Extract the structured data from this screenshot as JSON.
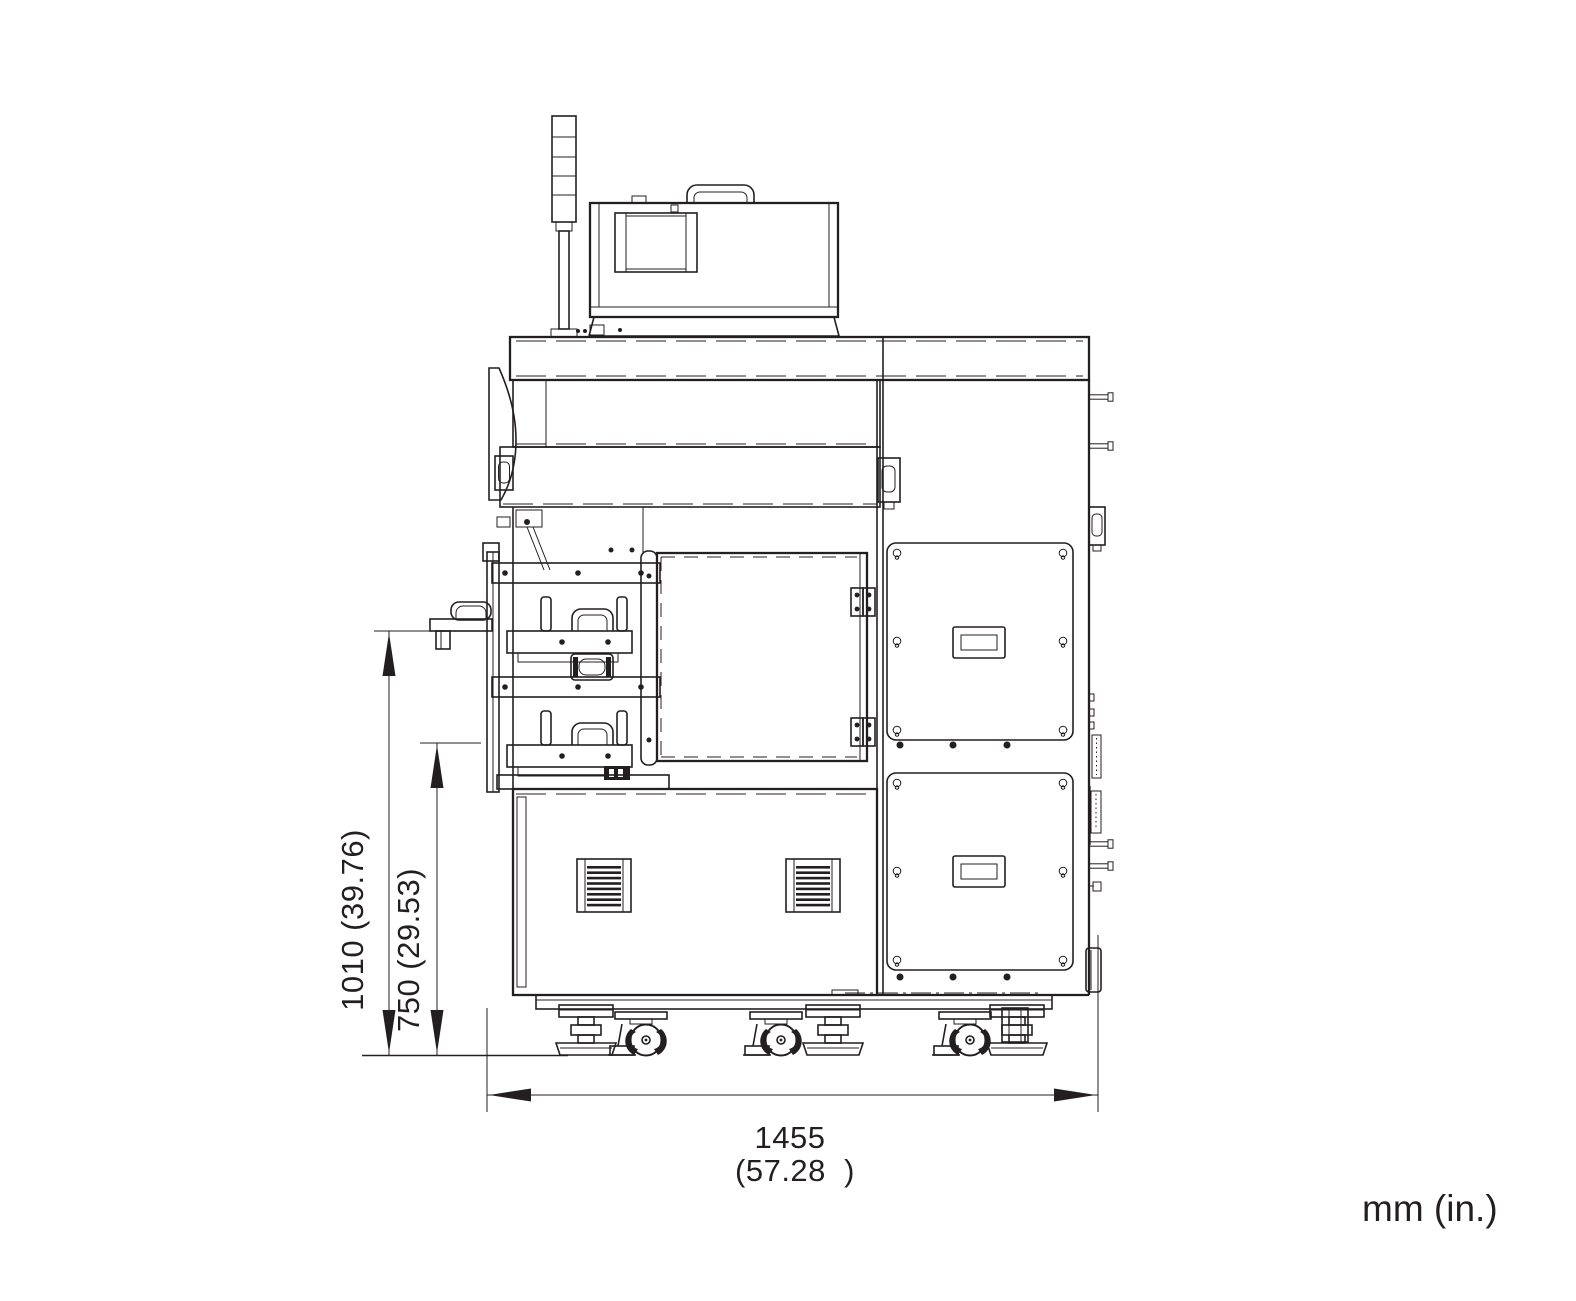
{
  "drawing": {
    "type": "technical-dimension-drawing",
    "view": "machine-front-elevation",
    "background": "#ffffff",
    "line_color": "#231f20",
    "units_note": "mm (in.)",
    "dimensions": {
      "overall_height": {
        "label": "1010 (39.76)",
        "mm": 1010,
        "inches": 39.76,
        "orientation": "vertical"
      },
      "tray_height": {
        "label": "750 (29.53)",
        "mm": 750,
        "inches": 29.53,
        "orientation": "vertical"
      },
      "overall_width": {
        "value_mm": "1455",
        "value_in": "(57.28  )",
        "mm": 1455,
        "inches": 57.28,
        "orientation": "horizontal"
      }
    }
  }
}
